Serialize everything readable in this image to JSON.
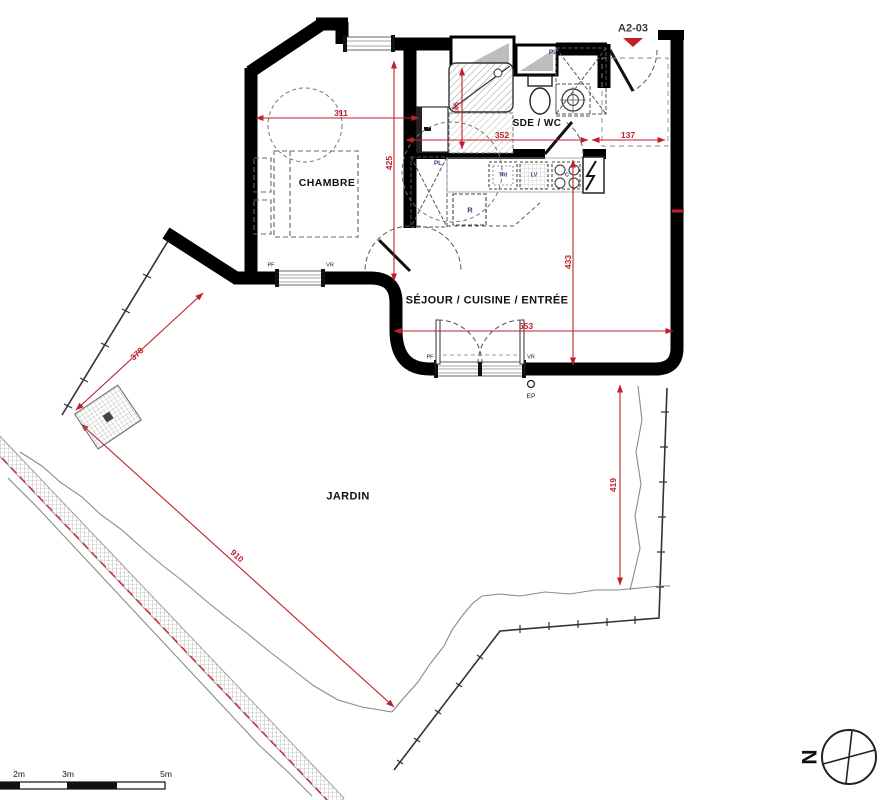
{
  "plan": {
    "reference": "A2-03",
    "rooms": {
      "bedroom": "CHAMBRE",
      "bathroom": "SDE / WC",
      "living": "SÉJOUR / CUISINE / ENTRÉE",
      "garden": "JARDIN"
    },
    "annotations": {
      "closet_kitchen": "PL",
      "closet_entry": "PL",
      "fridge": "R",
      "sorting": "TRI",
      "dishwasher": "LV",
      "cooktop": "C",
      "window_bedroom": "PF",
      "shutter_bedroom": "VR",
      "window_living": "PF",
      "shutter_living": "VR",
      "rainwater": "EP",
      "north": "N"
    },
    "dimensions": {
      "bedroom_width": "311",
      "bedroom_depth": "425",
      "shower_width": "185",
      "bath_width": "352",
      "entry_width": "137",
      "living_depth": "433",
      "living_width": "553",
      "garden_side_left": "378",
      "garden_diagonal": "910",
      "garden_side_right": "419"
    },
    "scale_bar": {
      "mark_2m": "2m",
      "mark_3m": "3m",
      "mark_5m": "5m"
    },
    "colors": {
      "wall": "#000000",
      "dimension": "#c21f2c",
      "appliance_label": "#31417e",
      "property_line": "#cc2a33",
      "ground_line": "#8a8a8a"
    }
  }
}
